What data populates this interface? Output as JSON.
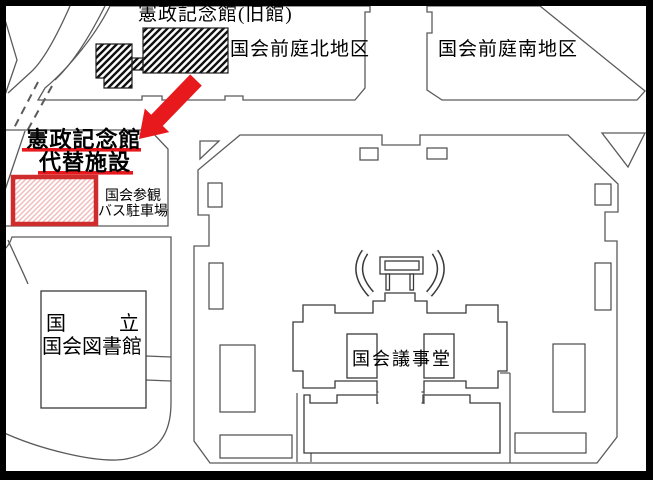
{
  "labels": {
    "old_hall": "憲政記念館(旧館)",
    "north_garden": "国会前庭北地区",
    "south_garden": "国会前庭南地区",
    "replacement_line1": "憲政記念館",
    "replacement_line2": "代替施設",
    "bus_parking_line1": "国会参観",
    "bus_parking_line2": "バス駐車場",
    "library_line1_left": "国",
    "library_line1_right": "立",
    "library_line2": "国会図書館",
    "diet_building": "国会議事堂"
  },
  "colors": {
    "accent_red": "#e8191d",
    "red_border": "#cf2d2d",
    "pink_hatch": "#f2bcbc",
    "map_line": "#5a5a5a",
    "frame": "#000000",
    "background": "#ffffff"
  }
}
